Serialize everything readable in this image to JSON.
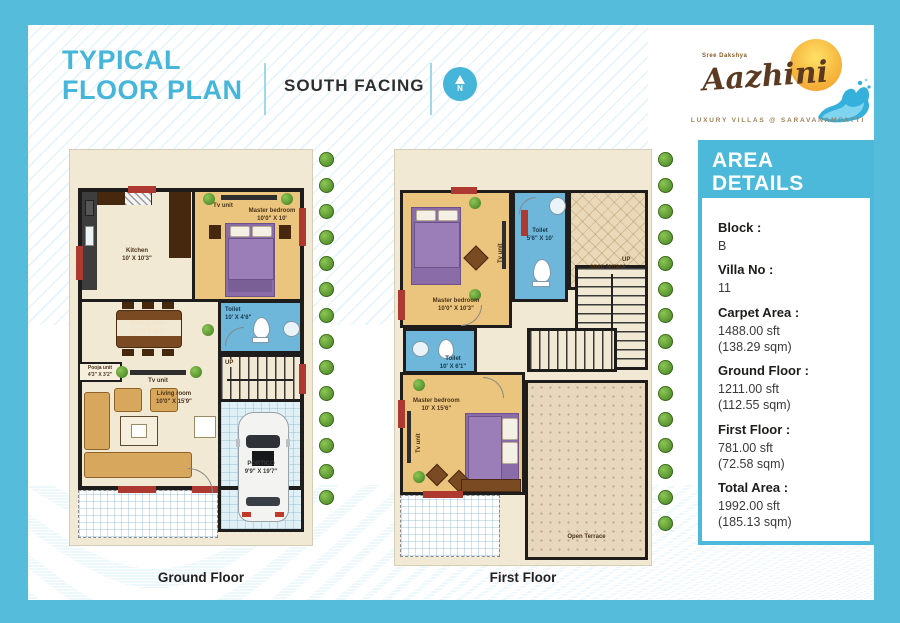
{
  "header": {
    "title_line1": "TYPICAL",
    "title_line2": "FLOOR PLAN",
    "facing": "SOUTH FACING",
    "compass_n": "N"
  },
  "logo": {
    "tagline_top": "Sree Dakshya",
    "name": "Aazhini",
    "tagline_bottom": "LUXURY VILLAS @ SARAVANAMPATTI"
  },
  "area_details": {
    "heading_line1": "AREA",
    "heading_line2": "DETAILS",
    "items": [
      {
        "label": "Block :",
        "value": "B"
      },
      {
        "label": "Villa No :",
        "value": "11"
      },
      {
        "label": "Carpet Area :",
        "value": "1488.00 sft",
        "value2": "(138.29 sqm)"
      },
      {
        "label": "Ground Floor :",
        "value": "1211.00 sft",
        "value2": "(112.55 sqm)"
      },
      {
        "label": "First Floor :",
        "value": "781.00 sft",
        "value2": "(72.58 sqm)"
      },
      {
        "label": "Total Area :",
        "value": "1992.00 sft",
        "value2": "(185.13 sqm)"
      }
    ]
  },
  "ground_floor": {
    "caption": "Ground Floor",
    "labels": {
      "kitchen": {
        "name": "Kitchen",
        "size": "10' X 10'3\""
      },
      "master_bedroom": {
        "name": "Master bedroom",
        "size": "10'0\" X 10'"
      },
      "tv_unit": "Tv unit",
      "toilet": {
        "name": "Toilet",
        "size": "10' X 4'6\""
      },
      "dining": {
        "name": "Dining room",
        "size": "10'0\" X 10'9\""
      },
      "pooja": {
        "name": "Pooja unit",
        "size": "4'3\" X 3'2\""
      },
      "living": {
        "name": "Living room",
        "size": "10'0\" X 15'9\""
      },
      "stairs_up": "UP",
      "portico": {
        "name": "PORTICO",
        "size": "9'9\" X 19'7\""
      }
    }
  },
  "first_floor": {
    "caption": "First Floor",
    "labels": {
      "master_bedroom_top": {
        "name": "Master bedroom",
        "size": "10'0\" X 10'3\""
      },
      "toilet_top": {
        "name": "Toilet",
        "size": "5'6\" X 10'"
      },
      "open_terrace_top": "open terrace",
      "toilet_mid": {
        "name": "Toilet",
        "size": "10' X 6'1\""
      },
      "master_bedroom_bottom": {
        "name": "Master bedroom",
        "size": "10' X 15'6\""
      },
      "tv_unit": "Tv unit",
      "open_terrace_bottom": "Open Terrace",
      "stairs_up": "UP"
    }
  }
}
